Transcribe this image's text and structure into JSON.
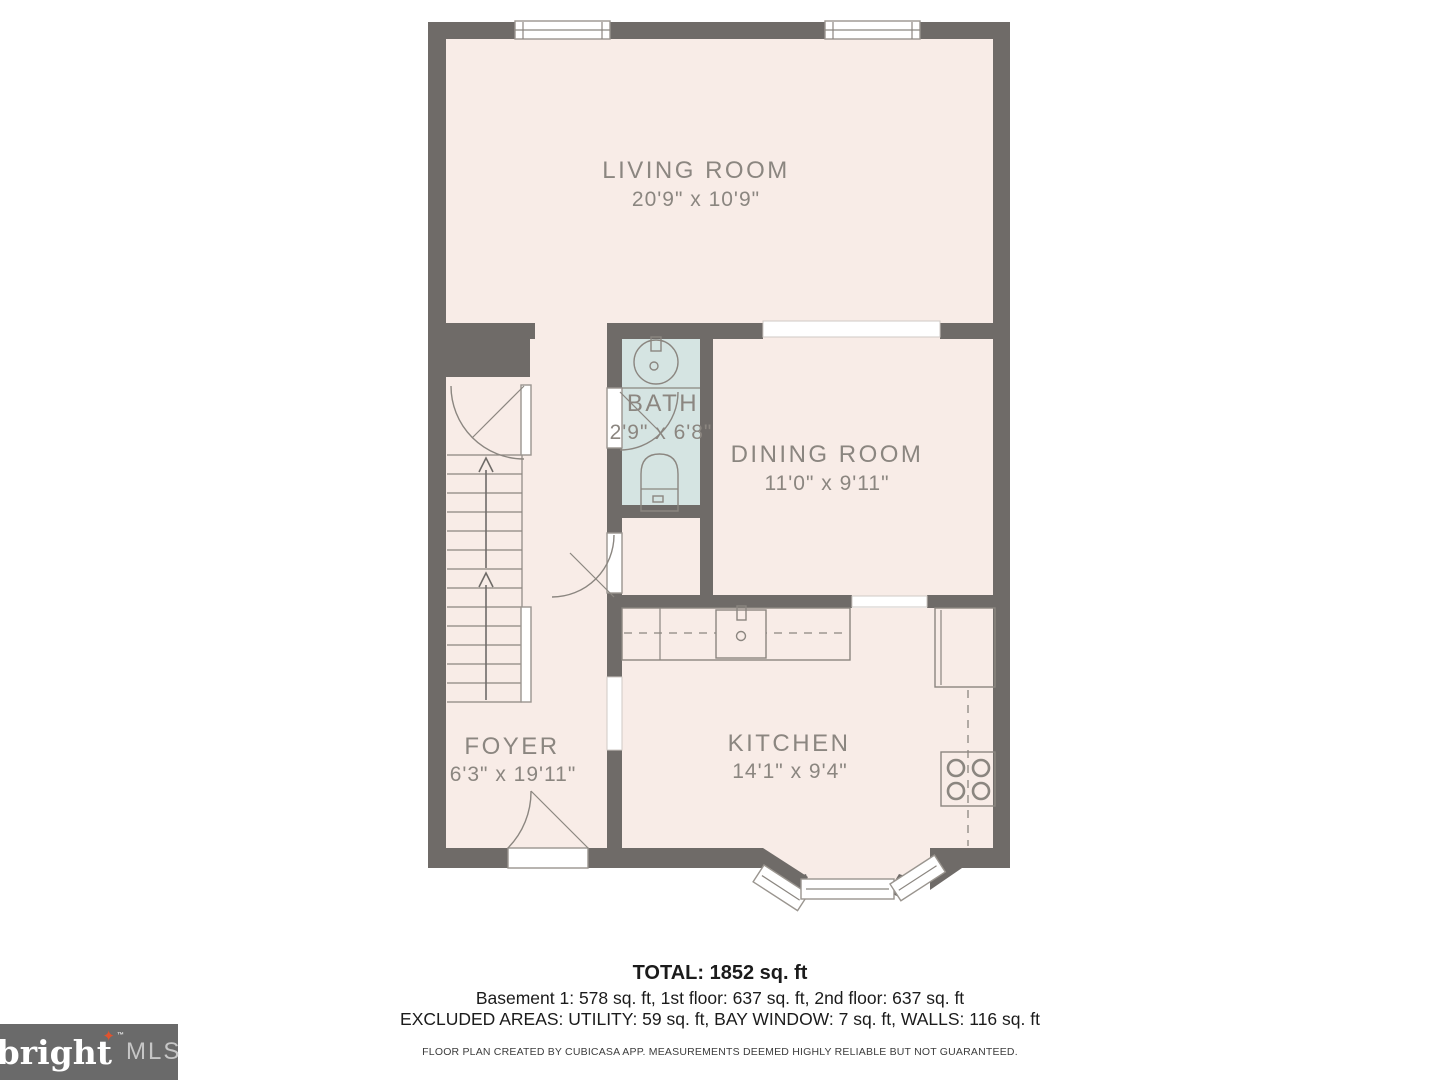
{
  "rooms": [
    {
      "name": "LIVING ROOM",
      "dims": "20'9\" x 10'9\""
    },
    {
      "name": "BATH",
      "dims": "2'9\" x 6'8\""
    },
    {
      "name": "DINING ROOM",
      "dims": "11'0\" x 9'11\""
    },
    {
      "name": "FOYER",
      "dims": "6'3\" x 19'11\""
    },
    {
      "name": "KITCHEN",
      "dims": "14'1\" x 9'4\""
    }
  ],
  "summary": {
    "total": "TOTAL: 1852 sq. ft",
    "floors": "Basement 1: 578 sq. ft, 1st floor: 637 sq. ft, 2nd floor: 637 sq. ft",
    "excluded": "EXCLUDED AREAS: UTILITY: 59 sq. ft, BAY WINDOW: 7 sq. ft, WALLS: 116 sq. ft",
    "disclaimer": "FLOOR PLAN CREATED BY CUBICASA APP. MEASUREMENTS DEEMED HIGHLY RELIABLE BUT NOT GUARANTEED."
  },
  "logo": {
    "brand": "bright",
    "suffix": "MLS",
    "tm": "™",
    "sparkle": "✦"
  },
  "colors": {
    "wall": "#6f6b68",
    "floor": "#f8ece7",
    "bath_floor": "#d5e4e2",
    "label": "#8b8680",
    "fixture": "#8b8680",
    "logo_bg": "#6a6a6a",
    "logo_orange": "#e0532e"
  }
}
